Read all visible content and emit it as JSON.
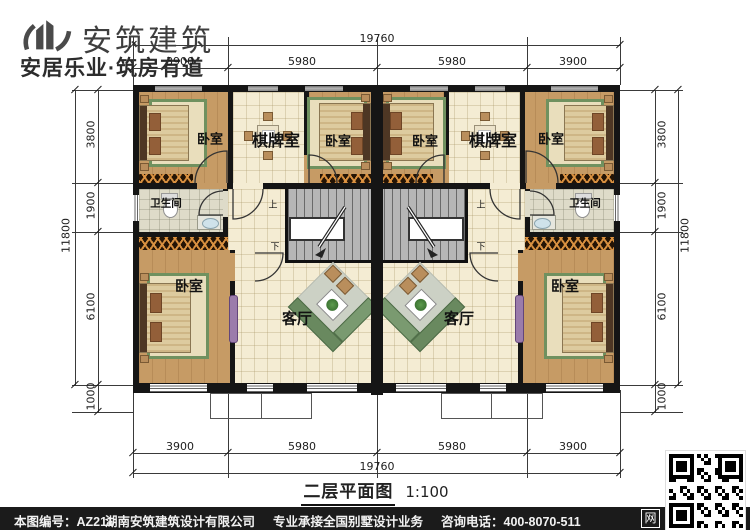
{
  "logo": {
    "brand": "安筑建筑",
    "slogan": "安居乐业·筑房有道"
  },
  "plan": {
    "title": "二层平面图",
    "scale": "1:100",
    "rooms": {
      "bedroom": "卧室",
      "game_room": "棋牌室",
      "bathroom": "卫生间",
      "living_room": "客厅"
    },
    "stairs": {
      "up": "上",
      "down": "下"
    },
    "dims": {
      "top_total": "19760",
      "bottom_total": "19760",
      "left_total": "11800",
      "right_total": "11800",
      "top_segments": [
        "3900",
        "5980",
        "5980",
        "3900"
      ],
      "bottom_segments": [
        "3900",
        "5980",
        "5980",
        "3900"
      ],
      "left_segments": [
        "3800",
        "1900",
        "6100",
        "1000"
      ],
      "right_segments": [
        "3800",
        "1900",
        "6100",
        "1000"
      ]
    },
    "watermark": "hunanazjz.com",
    "watermark_cn": "安筑建筑"
  },
  "footer": {
    "drawing_no": "本图编号：AZ211",
    "company": "湖南安筑建筑设计有限公司",
    "service": "专业承接全国别墅设计业务",
    "phone": "咨询电话：400-8070-511",
    "web": "网"
  }
}
